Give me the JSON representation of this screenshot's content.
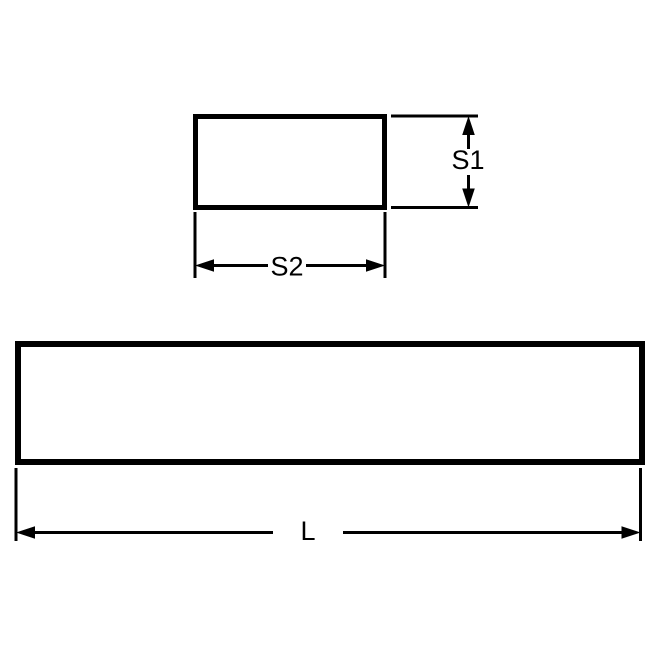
{
  "page": {
    "background_color": "#ffffff"
  },
  "drawing": {
    "stroke_color": "#000000",
    "labels": {
      "s1": "S1",
      "s2": "S2",
      "length": "L"
    }
  }
}
